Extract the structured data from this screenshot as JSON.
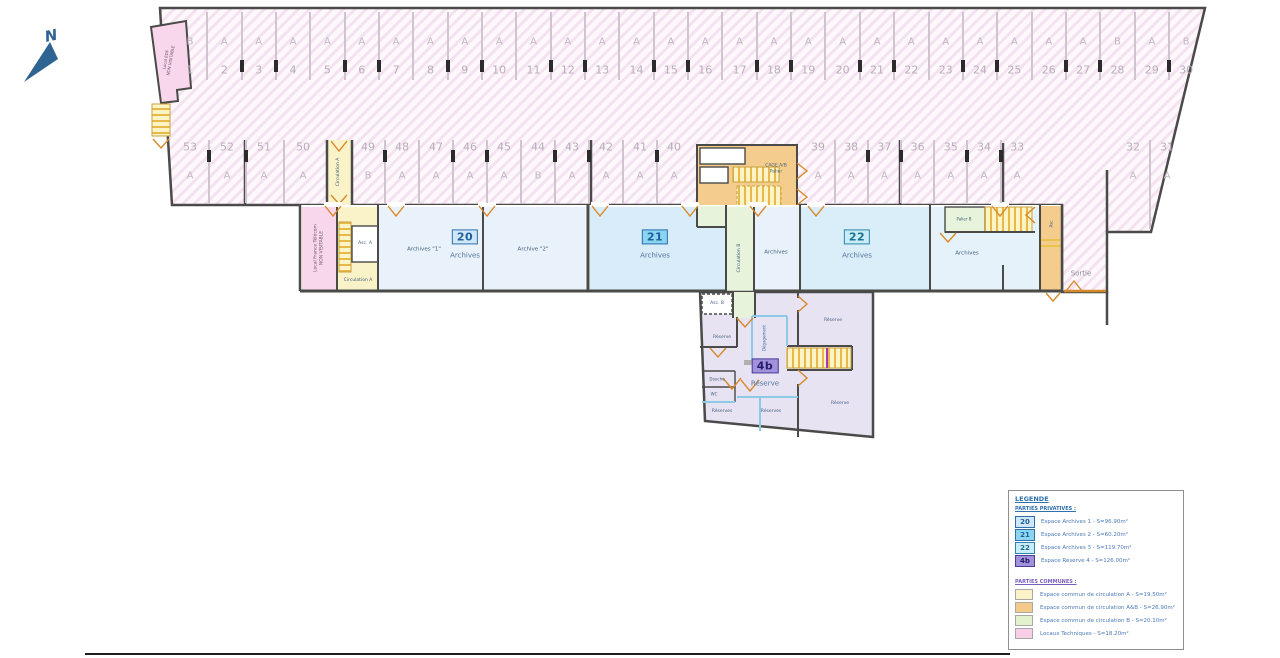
{
  "compass": {
    "label": "N"
  },
  "parking": {
    "rows": [
      {
        "id": "top",
        "spaces": [
          {
            "n": "1",
            "l": "B"
          },
          {
            "n": "2",
            "l": "A"
          },
          {
            "n": "3",
            "l": "A"
          },
          {
            "n": "4",
            "l": "A"
          },
          {
            "n": "5",
            "l": "A"
          },
          {
            "n": "6",
            "l": "A"
          },
          {
            "n": "7",
            "l": "A"
          },
          {
            "n": "8",
            "l": "A"
          },
          {
            "n": "9",
            "l": "A"
          },
          {
            "n": "10",
            "l": "A"
          },
          {
            "n": "11",
            "l": "A"
          },
          {
            "n": "12",
            "l": "A"
          },
          {
            "n": "13",
            "l": "A"
          },
          {
            "n": "14",
            "l": "A"
          },
          {
            "n": "15",
            "l": "A"
          },
          {
            "n": "16",
            "l": "A"
          },
          {
            "n": "17",
            "l": "A"
          },
          {
            "n": "18",
            "l": "A"
          },
          {
            "n": "19",
            "l": "A"
          },
          {
            "n": "20",
            "l": "A"
          },
          {
            "n": "21",
            "l": "A"
          },
          {
            "n": "22",
            "l": "A"
          },
          {
            "n": "23",
            "l": "A"
          },
          {
            "n": "24",
            "l": "A"
          },
          {
            "n": "25",
            "l": "A"
          },
          {
            "n": "26",
            "l": "A"
          },
          {
            "n": "27",
            "l": "A"
          },
          {
            "n": "28",
            "l": "B"
          },
          {
            "n": "29",
            "l": "A"
          },
          {
            "n": "30",
            "l": "B"
          }
        ]
      },
      {
        "id": "mid",
        "spaces": [
          {
            "n": "53",
            "l": "A"
          },
          {
            "n": "52",
            "l": "A"
          },
          {
            "n": "51",
            "l": "A"
          },
          {
            "n": "50",
            "l": "A"
          },
          {
            "n": "49",
            "l": "B"
          },
          {
            "n": "48",
            "l": "A"
          },
          {
            "n": "47",
            "l": "A"
          },
          {
            "n": "46",
            "l": "A"
          },
          {
            "n": "45",
            "l": "A"
          },
          {
            "n": "44",
            "l": "B"
          },
          {
            "n": "43",
            "l": "A"
          },
          {
            "n": "42",
            "l": "A"
          },
          {
            "n": "41",
            "l": "A"
          },
          {
            "n": "40",
            "l": "A"
          },
          {
            "n": "39",
            "l": "A"
          },
          {
            "n": "38",
            "l": "A"
          },
          {
            "n": "37",
            "l": "A"
          },
          {
            "n": "36",
            "l": "A"
          },
          {
            "n": "35",
            "l": "A"
          },
          {
            "n": "34",
            "l": "A"
          },
          {
            "n": "33",
            "l": "A"
          }
        ]
      },
      {
        "id": "right",
        "spaces": [
          {
            "n": "32",
            "l": "A"
          },
          {
            "n": "31",
            "l": "A"
          }
        ]
      }
    ]
  },
  "rooms": {
    "local_edf": "Local EDF",
    "non_visitable": "NON VISITABLE",
    "local_ft": "Local France Télécom",
    "circulation_a": "Circulation A",
    "circulation_b": "Circulation B",
    "asc_a": "Asc. A",
    "asc_b": "Asc. B",
    "asc": "Asc",
    "cage_ab": "CAGE A/B",
    "palier": "Palier",
    "palier_b": "Palier B",
    "archives": "Archives",
    "archives_1": "Archives \"1\"",
    "archive_2": "Archive \"2\"",
    "reserve": "Réserve",
    "reserves": "Réserves",
    "degagement": "Dégagement",
    "douche": "Douche",
    "wc": "WC",
    "sortie": "Sortie",
    "badge20": "20",
    "badge21": "21",
    "badge22": "22",
    "badge4b": "4b"
  },
  "legend": {
    "title": "LEGENDE",
    "private": {
      "heading": "PARTIES PRIVATIVES :",
      "items": [
        {
          "code": "20",
          "label": "Espace Archives 1 - S=96.90m²",
          "swatch": "#cfe7f8",
          "border": "#2f6fae",
          "text": "#1f5f9e"
        },
        {
          "code": "21",
          "label": "Espace Archives 2 - S=60.20m²",
          "swatch": "#8ad5f0",
          "border": "#2f6fae",
          "text": "#1f5f9e"
        },
        {
          "code": "22",
          "label": "Espace Archives 3 - S=119.70m²",
          "swatch": "#c9ecf8",
          "border": "#2b86a8",
          "text": "#17718f"
        },
        {
          "code": "4b",
          "label": "Espace Réserve 4 - S=126.00m²",
          "swatch": "#a392da",
          "border": "#4a3d9e",
          "text": "#221d6e"
        }
      ]
    },
    "common": {
      "heading": "PARTIES COMMUNES :",
      "items": [
        {
          "label": "Espace commun de circulation A - S=19.50m²",
          "swatch": "#fbf3c8"
        },
        {
          "label": "Espace commun de circulation A&B - S=26.90m²",
          "swatch": "#f4c98a"
        },
        {
          "label": "Espace commun de circulation B - S=20.10m²",
          "swatch": "#e2f2cf"
        },
        {
          "label": "Locaux Techniques - S=18.20m²",
          "swatch": "#f8cfe6"
        }
      ]
    }
  }
}
